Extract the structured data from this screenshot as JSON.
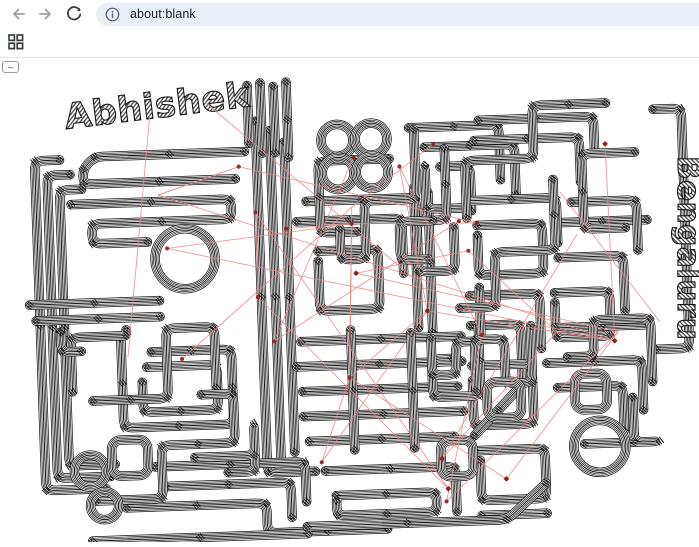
{
  "browser": {
    "url": "about:blank",
    "omnibox_bg": "#e9eef8",
    "back_icon": "back-arrow-icon",
    "forward_icon": "forward-arrow-icon",
    "refresh_icon": "refresh-icon",
    "info_icon": "page-info-icon",
    "icon_grey": "#9aa0a6",
    "icon_dark": "#3c4043"
  },
  "controls": {
    "grid_icon": "grid-2x2",
    "mini_button_label": "–"
  },
  "artwork": {
    "name_text": "Abhishek",
    "side_text": "Bengaluru",
    "trace_color": "#161616",
    "ratsnest_color": "#e48a8a",
    "pad_color": "#8b2020",
    "background": "#ffffff"
  }
}
